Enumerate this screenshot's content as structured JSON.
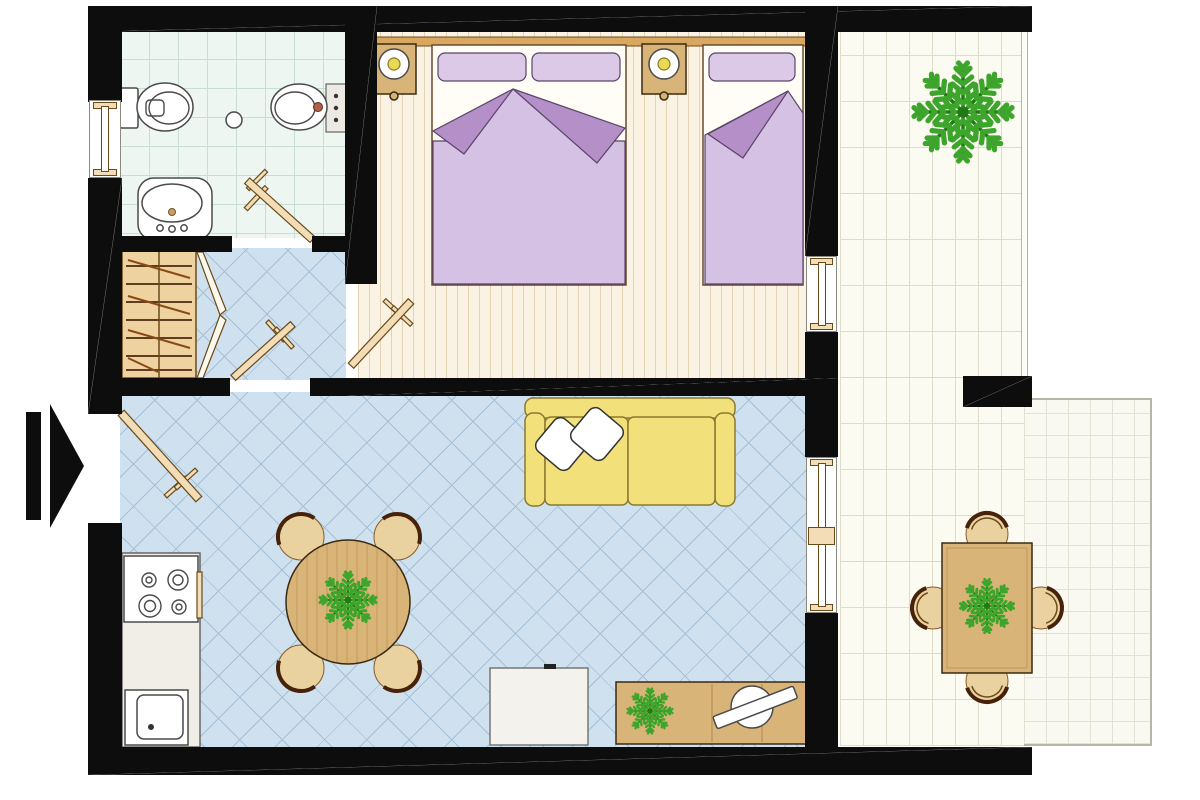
{
  "title": "one-bedroom-apartment-floor-plan",
  "entrance": {
    "symbol": "arrow-right",
    "position": "left-wall"
  },
  "rooms": [
    {
      "name": "bathroom",
      "floor": "mint-tile-grid",
      "furniture": [
        "toilet",
        "bidet",
        "washbasin",
        "floor-drain",
        "swing-door",
        "window"
      ]
    },
    {
      "name": "hallway",
      "floor": "blue-diamond-tile",
      "furniture": [
        "wardrobe-with-hangers",
        "open-wardrobe-doors",
        "swing-door"
      ]
    },
    {
      "name": "bedroom",
      "floor": "wood-plank",
      "furniture": [
        "headboard-shelf",
        "nightstand-with-lamp",
        "nightstand-with-lamp",
        "double-bed",
        "single-bed",
        "swing-door",
        "window"
      ]
    },
    {
      "name": "living-room",
      "floor": "blue-diamond-tile",
      "furniture": [
        "entrance-swing-door",
        "two-seat-sofa",
        "two-throw-pillows",
        "round-dining-table-with-plant",
        "four-chairs",
        "kitchen-counter",
        "stove-4-burners",
        "kitchen-sink",
        "white-chest",
        "sideboard-with-plant-and-tv",
        "sliding-window"
      ]
    },
    {
      "name": "balcony",
      "floor": "white-brick-tile",
      "furniture": [
        "large-plant"
      ]
    },
    {
      "name": "terrace",
      "floor": "white-grid-tile",
      "furniture": [
        "rectangular-table-with-plant",
        "four-chairs"
      ]
    }
  ],
  "colors": {
    "wall": "#0d0d0d",
    "floorBath": "#edf6f1",
    "lineBath": "#c8ded5",
    "floorWood": "#faf3e4",
    "lineWood": "#e4d4b4",
    "floorTile": "#cfe1ef",
    "lineTile": "#a4c0d6",
    "floorBalcony": "#fbfbf2",
    "lineBalcony": "#dcdcc8",
    "floorTerrace": "#f9f9f1",
    "lineTerrace": "#e2e2d2",
    "railing": "#b5b5a8",
    "wood": "#d9b478",
    "woodLight": "#eed2a0",
    "woodDark": "#5a3210",
    "door": "#f2ddb6",
    "doorEdge": "#6b4a1a",
    "headboard": "#d9a75f",
    "mattress": "#fffdf6",
    "bedEdge": "#6b4a2a",
    "pillow": "#dcc9e8",
    "pillowEdge": "#5a4468",
    "blanket": "#d5c1e3",
    "blanketFold": "#b48fc8",
    "sofa": "#f2e07a",
    "sofaEdge": "#8a7a30",
    "cushion": "#ffffff",
    "fixture": "#ffffff",
    "fixtureEdge": "#4a4a4a",
    "counter": "#f1eee7",
    "chairSeat": "#ead2a0",
    "chairArc": "#46220a",
    "plant": "#3da52c",
    "plantDark": "#1f7a14",
    "lampBulb": "#ead954",
    "accentTap": "#b06048",
    "arrow": "#0d0d0d"
  }
}
